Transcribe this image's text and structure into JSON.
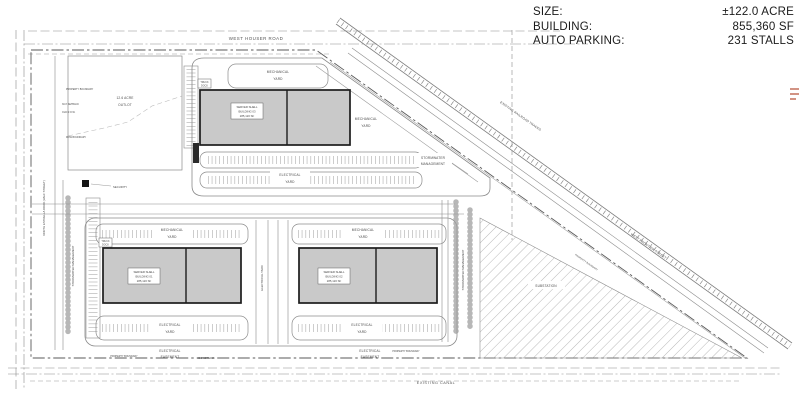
{
  "legend": {
    "rows": [
      {
        "label": "SIZE:",
        "value": "±122.0 ACRE"
      },
      {
        "label": "BUILDING:",
        "value": "855,360 SF"
      },
      {
        "label": "AUTO PARKING:",
        "value": "231 STALLS"
      }
    ]
  },
  "roads": {
    "north": "WEST HOUSER ROAD",
    "west": "NORTH ESTRELLA ROAD (HALF STREET)",
    "railroad": "EXISTING RAILROAD TRACKS",
    "frontier": "WEST FRONTIER STREET",
    "canal": "EXISTING CANAL"
  },
  "buildings": [
    {
      "line1": "SERVER SHELL",
      "line2": "BUILDING 03",
      "size": "285,120 SF"
    },
    {
      "line1": "SERVER SHELL",
      "line2": "BUILDING 01",
      "size": "285,120 SF"
    },
    {
      "line1": "SERVER SHELL",
      "line2": "BUILDING 02",
      "size": "285,120 SF"
    }
  ],
  "areas": {
    "outlot_line1": "12.6 ACRE",
    "outlot_line2": "OUTLOT",
    "substation": "SUBSTATION",
    "mechanical_line1": "MECHANICAL",
    "mechanical_line2": "YARD",
    "electrical_line1": "ELECTRICAL",
    "electrical_line2": "YARD",
    "electrical_yard_vertical": "ELECTRICAL YARD",
    "easement_line1": "ELECTRICAL",
    "easement_line2": "EASEMENT",
    "stormwater_line1": "STORMWATER",
    "stormwater_line2": "MANAGEMENT",
    "stormwater_vertical": "STORMWATER MANAGEMENT"
  },
  "annotations": {
    "property_boundary": "PROPERTY BOUNDARY",
    "setback": "30.0' SETBACK",
    "old_row": "OLD R.O.W.",
    "row_boundary": "ROW BOUNDARY",
    "security": "SECURITY",
    "truck_line1": "TRUCK",
    "truck_line2": "DOCK"
  },
  "colors": {
    "building_fill": "#c9c9c9",
    "building_stroke": "#1c1c1c",
    "linework": "#8c8c8c",
    "label_text": "#4a4a4a",
    "edge_mark_red": "#b34a32"
  }
}
